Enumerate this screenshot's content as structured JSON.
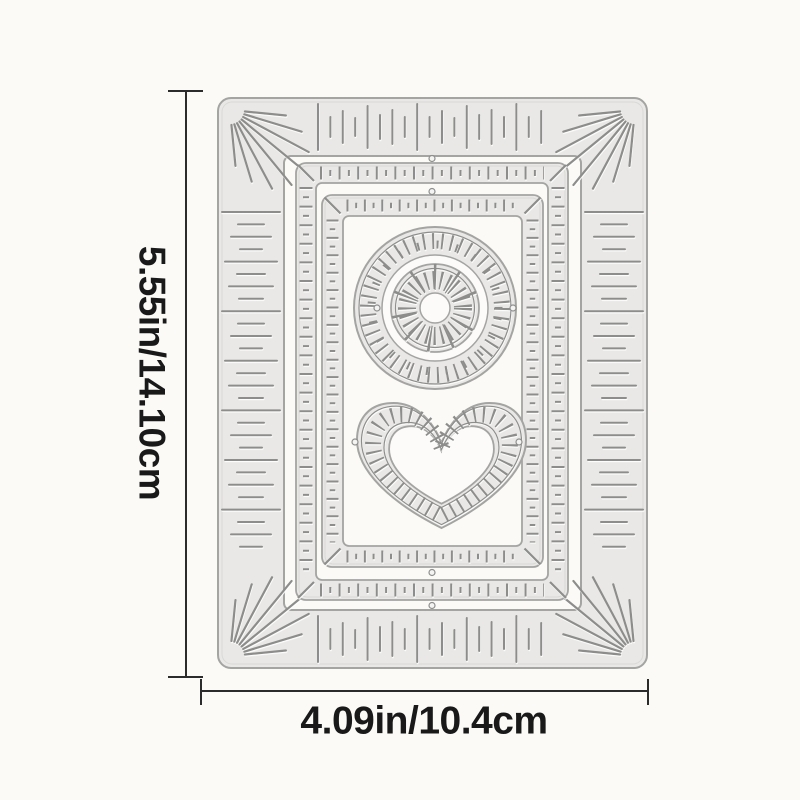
{
  "annotations": {
    "height_label": "5.55in/14.10cm",
    "width_label": "4.09in/10.4cm"
  },
  "colors": {
    "background": "#fbfaf7",
    "plate_fill": "#e9e8e6",
    "plate_edge": "#a4a4a2",
    "plate_highlight": "#d9d9d6",
    "etch": "#8d8d8b",
    "hole_fill": "#fcfbf9",
    "nub_fill": "#f4f4f2",
    "nub_edge": "#8f8f8f",
    "annotation_line": "#2b2b2b",
    "annotation_text": "#191919"
  },
  "die_parts": [
    "outer-sunburst-frame-die",
    "middle-stitch-frame-die",
    "inner-stitch-frame-die",
    "sunburst-circle-die",
    "stitch-heart-die"
  ]
}
